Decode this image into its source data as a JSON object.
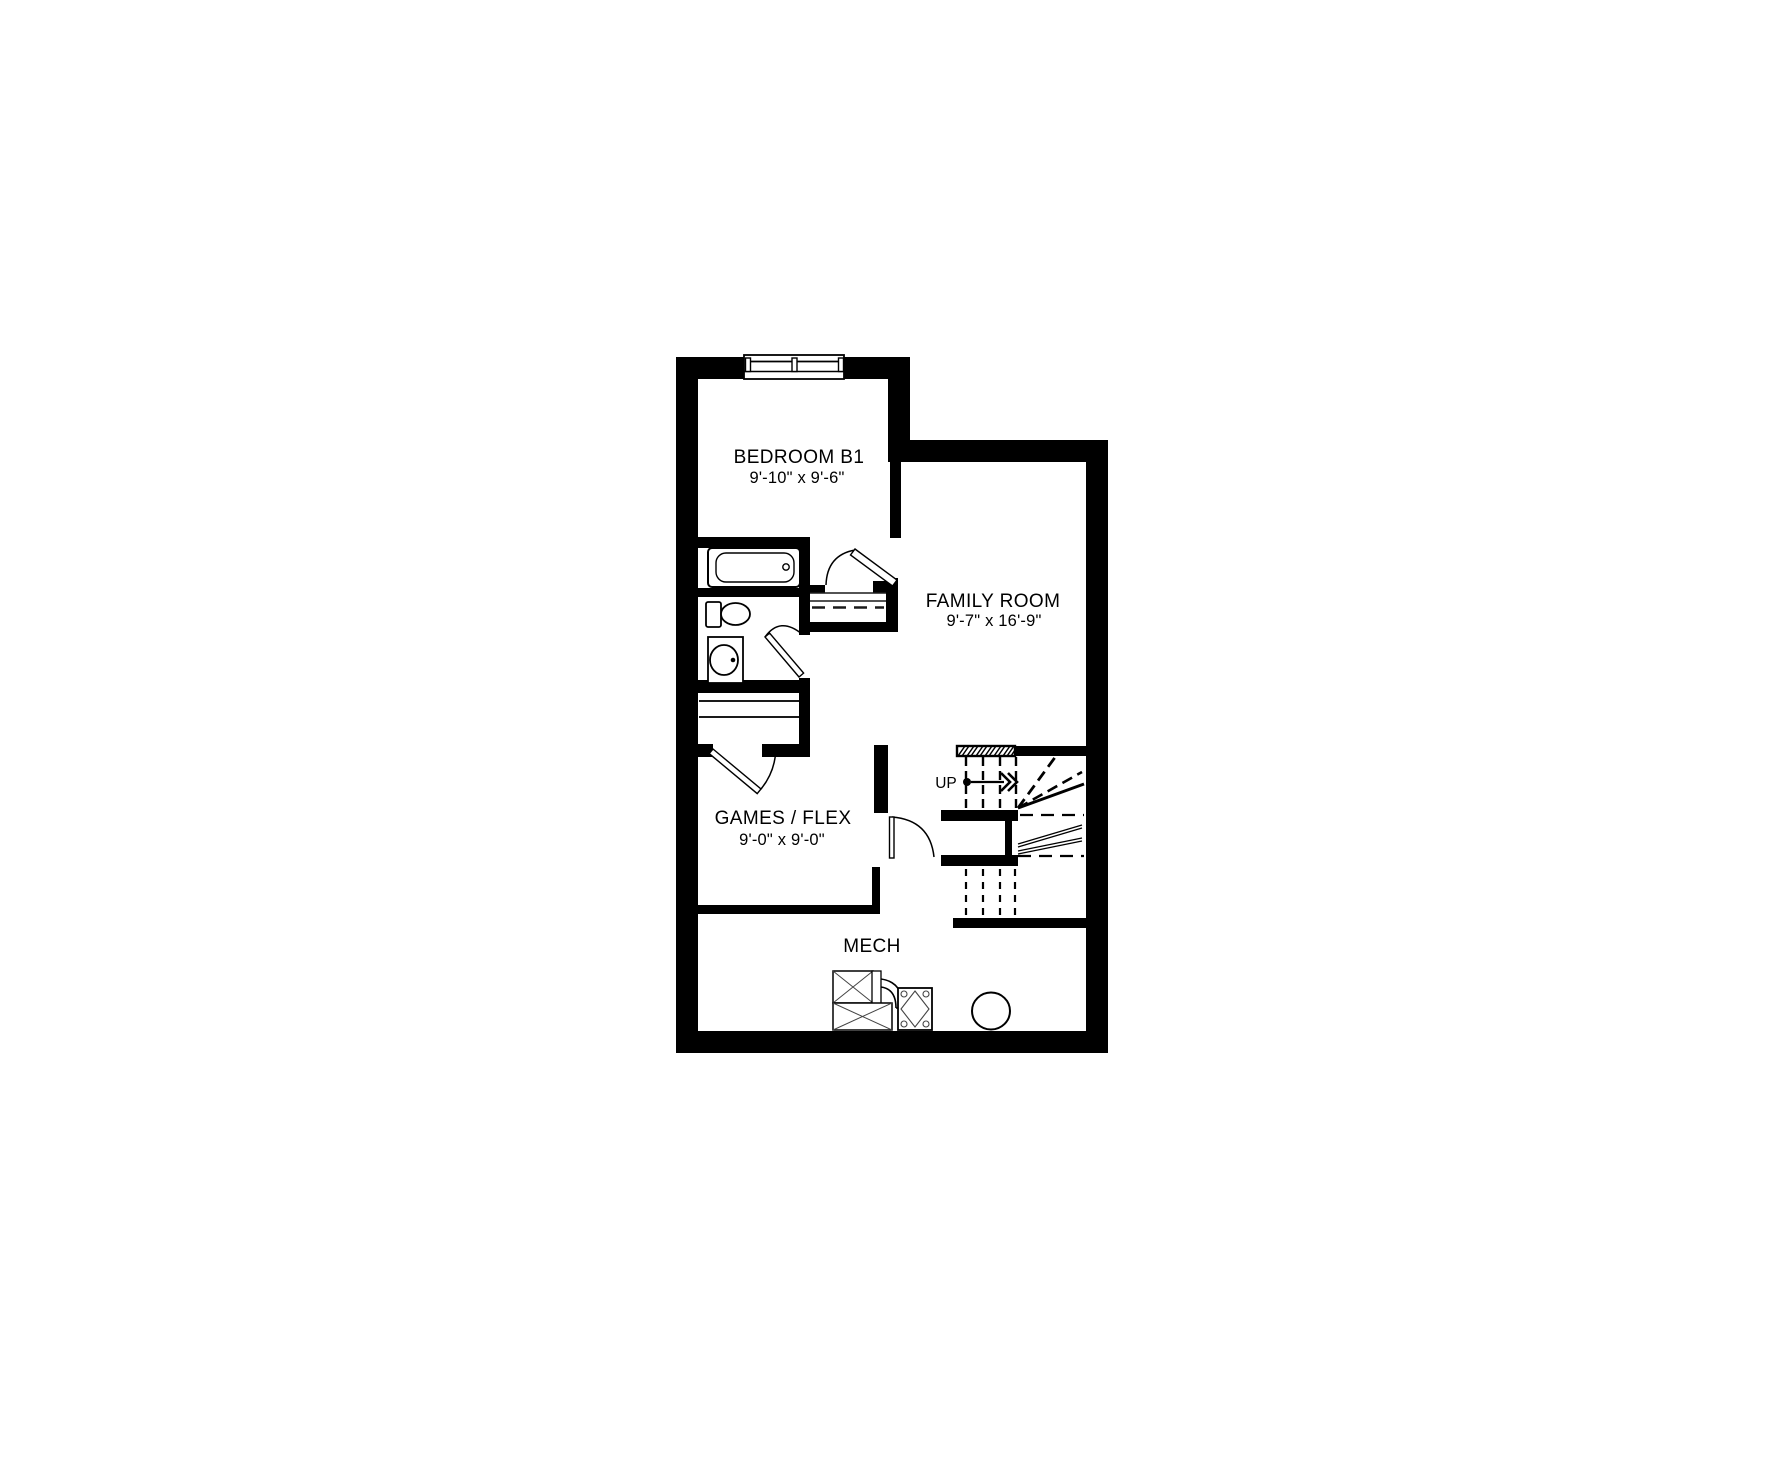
{
  "rooms": {
    "bedroom": {
      "label": "BEDROOM B1",
      "dims": "9'-10\" x 9'-6\""
    },
    "family": {
      "label": "FAMILY ROOM",
      "dims": "9'-7\" x 16'-9\""
    },
    "games": {
      "label": "GAMES / FLEX",
      "dims": "9'-0\" x 9'-0\""
    },
    "mech": {
      "label": "MECH"
    }
  },
  "stairs": {
    "up_label": "UP"
  },
  "fixtures": {
    "bedroom": [
      "window"
    ],
    "bathroom": [
      "bathtub",
      "toilet",
      "sink-vanity"
    ],
    "closet": [
      "linen-shelves"
    ],
    "mech": [
      "furnace",
      "hrv-unit",
      "water-heater-tank"
    ]
  },
  "colors": {
    "walls": "#000000",
    "lines": "#1a1a1a",
    "background": "#ffffff"
  }
}
